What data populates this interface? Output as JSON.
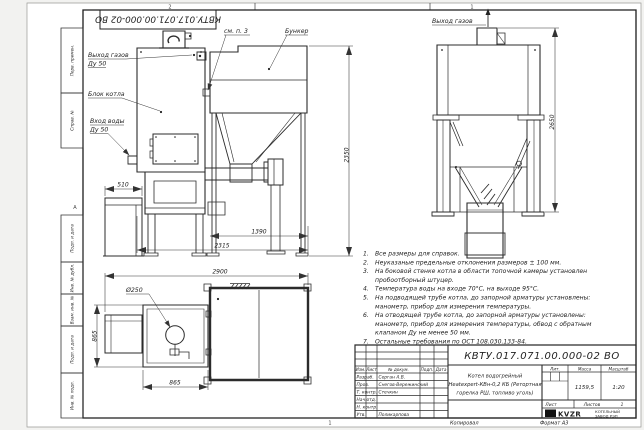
{
  "sheet": {
    "corner_code": "КВТУ.017.071.00.000-02 ВО",
    "zone_top_left": "2",
    "zone_top_right": "1",
    "zone_bottom": "1",
    "zone_left": "А",
    "footer_copied": "Копировал",
    "footer_format": "Формат А3"
  },
  "margin": {
    "labels": [
      "Перв. примен.",
      "Справ. №",
      "Подп. и дата",
      "Инв. № дубл.",
      "Взам. инв. №",
      "Подп. и дата",
      "Инв. № подл."
    ]
  },
  "front_view": {
    "gas_out": "Выход газов",
    "gas_out_dn": "Ду 50",
    "boiler_block": "Блок котла",
    "water_in": "Вход воды",
    "water_in_dn": "Ду 50",
    "see_note": "см. п. 3",
    "bunker": "Бункер",
    "dim_fan": "510",
    "dim_bunker": "1390",
    "dim_total": "2315",
    "dim_height": "2350"
  },
  "rear_view": {
    "gas_out": "Выход газов",
    "dim_height": "2650"
  },
  "plan_view": {
    "dim_total": "2900",
    "dim_dia": "Ø250",
    "dim_depth": "865",
    "dim_width": "865"
  },
  "notes": {
    "n1num": "1.",
    "n1": "Все размеры для справок.",
    "n2num": "2.",
    "n2": "Неуказаные предельные отклонения размеров ± 100 мм.",
    "n3num": "3.",
    "n3a": "На боковой стенке котла в области топочной камеры установлен",
    "n3b": "пробоотборный штуцер.",
    "n4num": "4.",
    "n4": "Температура воды на входе 70°С, на выходе 95°С.",
    "n5num": "5.",
    "n5a": "На подводящей трубе котла, до запорной арматуры установлены:",
    "n5b": "манометр, прибор для измерения температуры.",
    "n6num": "6.",
    "n6a": "На отводящей трубе котла, до запорной арматуры установлены:",
    "n6b": "манометр, прибор для измерения температуры, обвод с обратным",
    "n6c": "клапаном Ду не менее 50 мм.",
    "n7num": "7.",
    "n7": "Остальные требования по ОСТ 108.030.133-84."
  },
  "title_block": {
    "code": "КВТУ.017.071.00.000-02 ВО",
    "name1": "Котел водогрейный",
    "name2": "Heatexpert-КВн-0,2 КБ (Ретортная",
    "name3": "горелка РШ, топливо уголь)",
    "col_izm": "Изм.",
    "col_list": "Лист",
    "col_doc": "№ докум.",
    "col_podp": "Подп.",
    "col_data": "Дата",
    "row_razrab": "Разраб.",
    "row_prov": "Пров.",
    "row_tkontr": "Т. контр.",
    "row_nachotd": "Нач.отд.",
    "row_nkontr": "Н. контр.",
    "row_utv": "Утв.",
    "name_razrab": "Серган А.В.",
    "name_prov": "Снегов-Вережинский",
    "name_tkontr": "Стечкин",
    "name_utv": "Поликарпова",
    "lit": "Лит.",
    "mass": "Масса",
    "scale": "Масштаб",
    "mass_value": "1159,5",
    "scale_value": "1:20",
    "sheet": "Лист",
    "sheets": "Листов",
    "sheets_value": "1",
    "logo": "KVZR",
    "company1": "КОТЕЛЬНЫЙ",
    "company2": "ЗАВОД РЭП"
  }
}
